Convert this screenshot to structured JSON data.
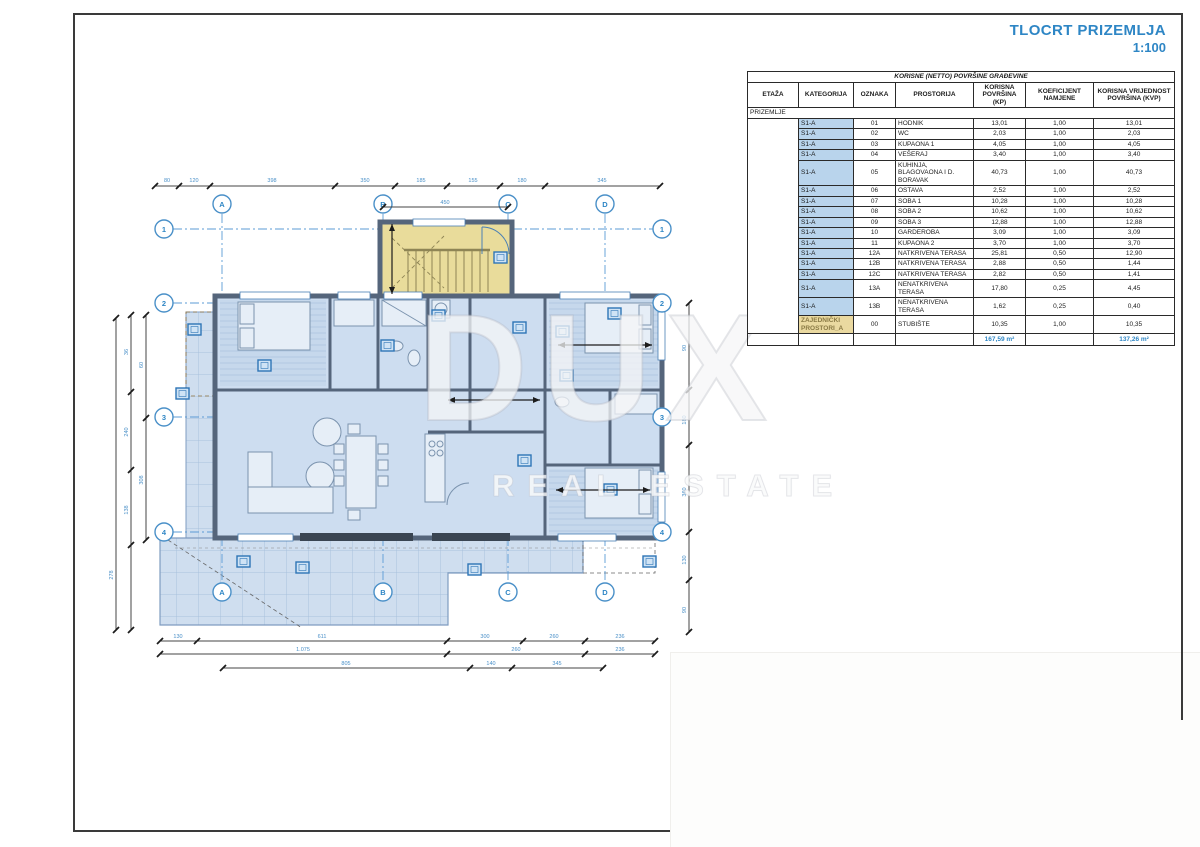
{
  "title": {
    "line1": "TLOCRT PRIZEMLJA",
    "line2": "1:100"
  },
  "watermark": {
    "line1": "DUX",
    "line2": "REAL ESTATE"
  },
  "table": {
    "title": "KORISNE (NETTO) POVRŠINE GRAĐEVINE",
    "headers": [
      "ETAŽA",
      "KATEGORIJA",
      "OZNAKA",
      "PROSTORIJA",
      "KORISNA POVRŠINA (KP)",
      "KOEFICIJENT NAMJENE",
      "KORISNA VRIJEDNOST POVRŠINA (KVP)"
    ],
    "floor_band": "PRIZEMLJE",
    "rows": [
      {
        "kategorija": "S1-A",
        "oznaka": "01",
        "prostorija": "HODNIK",
        "kp": "13,01",
        "koef": "1,00",
        "kvp": "13,01",
        "common": false
      },
      {
        "kategorija": "S1-A",
        "oznaka": "02",
        "prostorija": "WC",
        "kp": "2,03",
        "koef": "1,00",
        "kvp": "2,03",
        "common": false
      },
      {
        "kategorija": "S1-A",
        "oznaka": "03",
        "prostorija": "KUPAONA 1",
        "kp": "4,05",
        "koef": "1,00",
        "kvp": "4,05",
        "common": false
      },
      {
        "kategorija": "S1-A",
        "oznaka": "04",
        "prostorija": "VEŠERAJ",
        "kp": "3,40",
        "koef": "1,00",
        "kvp": "3,40",
        "common": false
      },
      {
        "kategorija": "S1-A",
        "oznaka": "05",
        "prostorija": "KUHINJA, BLAGOVAONA I D. BORAVAK",
        "kp": "40,73",
        "koef": "1,00",
        "kvp": "40,73",
        "common": false
      },
      {
        "kategorija": "S1-A",
        "oznaka": "06",
        "prostorija": "OSTAVA",
        "kp": "2,52",
        "koef": "1,00",
        "kvp": "2,52",
        "common": false
      },
      {
        "kategorija": "S1-A",
        "oznaka": "07",
        "prostorija": "SOBA 1",
        "kp": "10,28",
        "koef": "1,00",
        "kvp": "10,28",
        "common": false
      },
      {
        "kategorija": "S1-A",
        "oznaka": "08",
        "prostorija": "SOBA 2",
        "kp": "10,62",
        "koef": "1,00",
        "kvp": "10,62",
        "common": false
      },
      {
        "kategorija": "S1-A",
        "oznaka": "09",
        "prostorija": "SOBA 3",
        "kp": "12,88",
        "koef": "1,00",
        "kvp": "12,88",
        "common": false
      },
      {
        "kategorija": "S1-A",
        "oznaka": "10",
        "prostorija": "GARDEROBA",
        "kp": "3,09",
        "koef": "1,00",
        "kvp": "3,09",
        "common": false
      },
      {
        "kategorija": "S1-A",
        "oznaka": "11",
        "prostorija": "KUPAONA 2",
        "kp": "3,70",
        "koef": "1,00",
        "kvp": "3,70",
        "common": false
      },
      {
        "kategorija": "S1-A",
        "oznaka": "12A",
        "prostorija": "NATKRIVENA TERASA",
        "kp": "25,81",
        "koef": "0,50",
        "kvp": "12,90",
        "common": false
      },
      {
        "kategorija": "S1-A",
        "oznaka": "12B",
        "prostorija": "NATKRIVENA TERASA",
        "kp": "2,88",
        "koef": "0,50",
        "kvp": "1,44",
        "common": false
      },
      {
        "kategorija": "S1-A",
        "oznaka": "12C",
        "prostorija": "NATKRIVENA TERASA",
        "kp": "2,82",
        "koef": "0,50",
        "kvp": "1,41",
        "common": false
      },
      {
        "kategorija": "S1-A",
        "oznaka": "13A",
        "prostorija": "NENATKRIVENA TERASA",
        "kp": "17,80",
        "koef": "0,25",
        "kvp": "4,45",
        "common": false
      },
      {
        "kategorija": "S1-A",
        "oznaka": "13B",
        "prostorija": "NENATKRIVENA TERASA",
        "kp": "1,62",
        "koef": "0,25",
        "kvp": "0,40",
        "common": false
      },
      {
        "kategorija": "ZAJEDNIČKI PROSTORI_A",
        "oznaka": "00",
        "prostorija": "STUBIŠTE",
        "kp": "10,35",
        "koef": "1,00",
        "kvp": "10,35",
        "common": true
      }
    ],
    "totals": {
      "kp": "167,59 m²",
      "kvp": "137,26 m²"
    }
  },
  "plan": {
    "grid_columns": [
      "A",
      "B",
      "C",
      "D"
    ],
    "grid_rows": [
      "1",
      "2",
      "3",
      "4"
    ],
    "dims": {
      "top": [
        "80",
        "120",
        "398",
        "350",
        "185",
        "155",
        "180",
        "345"
      ],
      "top_sub": [
        "450"
      ],
      "left": [
        "36",
        "240",
        "138",
        "60",
        "308",
        "278"
      ],
      "right": [
        "90",
        "180",
        "360",
        "130",
        "90"
      ],
      "bottom1": [
        "130",
        "611",
        "300",
        "260",
        "236"
      ],
      "bottom2": [
        "1.075",
        "260",
        "236"
      ],
      "bottom3": [
        "805",
        "140",
        "345"
      ]
    },
    "colors": {
      "accent_blue": "#2e86c5",
      "plan_fill": "#cdddf0",
      "terrace_fill": "#cfdeef",
      "stair_fill": "#e9dc9b",
      "wall": "#55657b",
      "kategorija_bg": "#b9d4ec",
      "common_bg": "#ead9a0"
    }
  }
}
